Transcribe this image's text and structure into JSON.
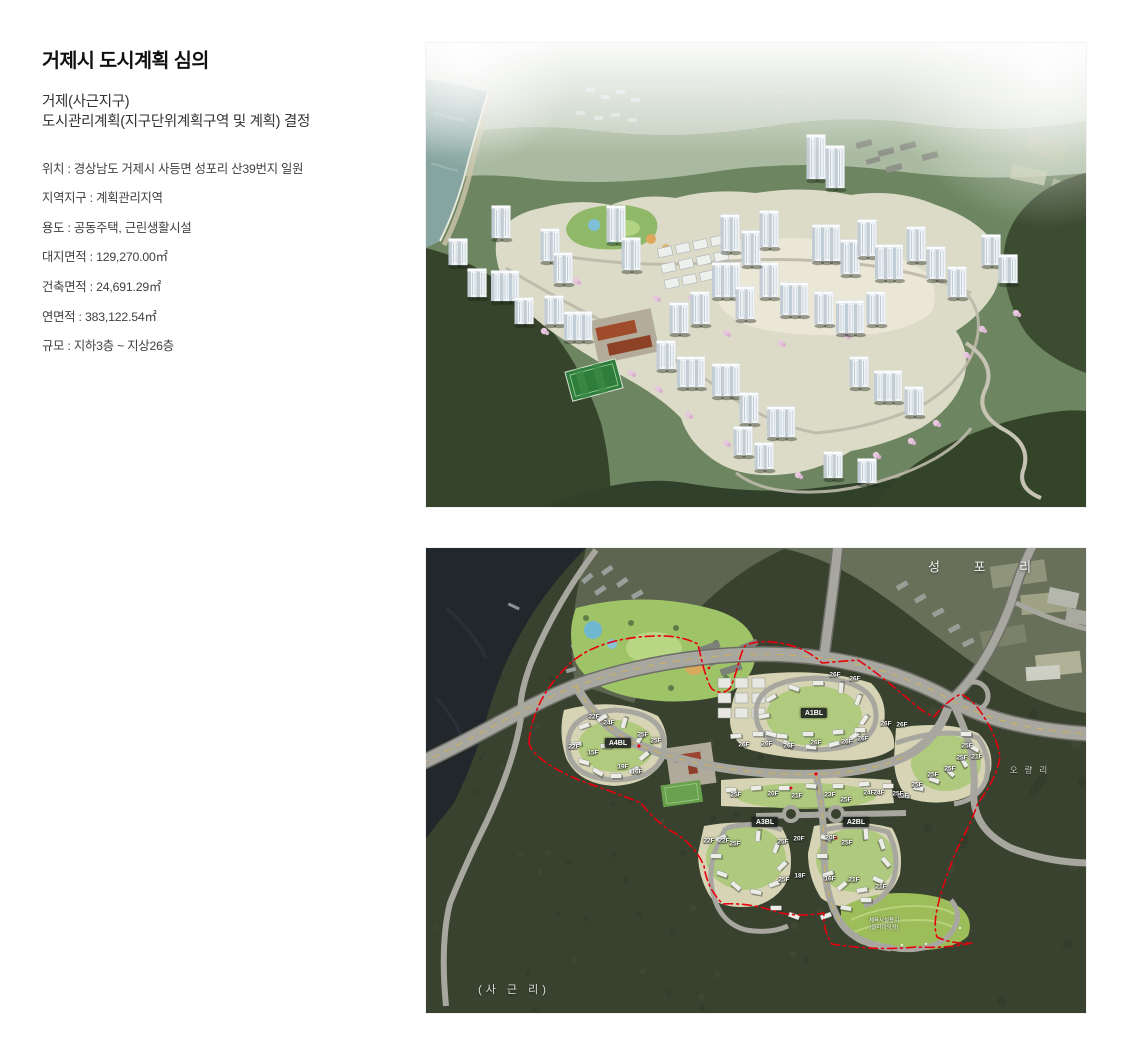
{
  "info": {
    "title": "거제시 도시계획 심의",
    "subtitle_line1": "거제(사근지구)",
    "subtitle_line2": "도시관리계획(지구단위계획구역 및 계획) 결정",
    "details": [
      "위치 : 경상남도 거제시 사등면 성포리 산39번지 일원",
      "지역지구 : 계획관리지역",
      "용도 : 공동주택, 근린생활시설",
      "대지면적 : 129,270.00㎡",
      "건축면적 : 24,691.29㎡",
      "연면적 : 383,122.54㎡",
      "규모 : 지하3층 ~ 지상26층"
    ]
  },
  "site_plan": {
    "place_labels": [
      {
        "text": "성 포 리",
        "x": 561,
        "y": 18,
        "kind": "seongpo"
      },
      {
        "text": "(사 근 리)",
        "x": 88,
        "y": 441,
        "kind": "sageun"
      },
      {
        "text": "오량리",
        "x": 606,
        "y": 222,
        "kind": "oryang"
      }
    ],
    "block_labels": [
      {
        "text": "A1BL",
        "x": 388,
        "y": 165
      },
      {
        "text": "A4BL",
        "x": 192,
        "y": 195
      },
      {
        "text": "A3BL",
        "x": 339,
        "y": 274
      },
      {
        "text": "A2BL",
        "x": 430,
        "y": 274
      }
    ],
    "floor_labels": [
      {
        "t": "26F",
        "x": 409,
        "y": 127
      },
      {
        "t": "26F",
        "x": 429,
        "y": 131
      },
      {
        "t": "26F",
        "x": 460,
        "y": 176
      },
      {
        "t": "26F",
        "x": 476,
        "y": 177
      },
      {
        "t": "26F",
        "x": 318,
        "y": 197
      },
      {
        "t": "26F",
        "x": 341,
        "y": 196
      },
      {
        "t": "26F",
        "x": 363,
        "y": 198
      },
      {
        "t": "26F",
        "x": 390,
        "y": 195
      },
      {
        "t": "26F",
        "x": 421,
        "y": 194
      },
      {
        "t": "26F",
        "x": 437,
        "y": 191
      },
      {
        "t": "25F",
        "x": 541,
        "y": 198
      },
      {
        "t": "25F",
        "x": 536,
        "y": 210
      },
      {
        "t": "21F",
        "x": 551,
        "y": 209
      },
      {
        "t": "25F",
        "x": 524,
        "y": 221
      },
      {
        "t": "25F",
        "x": 507,
        "y": 227
      },
      {
        "t": "25F",
        "x": 491,
        "y": 237
      },
      {
        "t": "25F",
        "x": 477,
        "y": 248
      },
      {
        "t": "22F",
        "x": 168,
        "y": 169
      },
      {
        "t": "24F",
        "x": 183,
        "y": 175
      },
      {
        "t": "25F",
        "x": 217,
        "y": 187
      },
      {
        "t": "25F",
        "x": 230,
        "y": 193
      },
      {
        "t": "22F",
        "x": 148,
        "y": 199
      },
      {
        "t": "15F",
        "x": 167,
        "y": 205
      },
      {
        "t": "19F",
        "x": 197,
        "y": 219
      },
      {
        "t": "16F",
        "x": 211,
        "y": 224
      },
      {
        "t": "25F",
        "x": 310,
        "y": 247
      },
      {
        "t": "20F",
        "x": 347,
        "y": 246
      },
      {
        "t": "21F",
        "x": 371,
        "y": 248
      },
      {
        "t": "23F",
        "x": 404,
        "y": 247
      },
      {
        "t": "25F",
        "x": 420,
        "y": 252
      },
      {
        "t": "24F",
        "x": 443,
        "y": 245
      },
      {
        "t": "24F",
        "x": 453,
        "y": 245
      },
      {
        "t": "25F",
        "x": 472,
        "y": 246
      },
      {
        "t": "22F",
        "x": 283,
        "y": 293
      },
      {
        "t": "22F",
        "x": 298,
        "y": 293
      },
      {
        "t": "25F",
        "x": 309,
        "y": 296
      },
      {
        "t": "25F",
        "x": 357,
        "y": 294
      },
      {
        "t": "20F",
        "x": 373,
        "y": 291
      },
      {
        "t": "20F",
        "x": 405,
        "y": 290
      },
      {
        "t": "25F",
        "x": 421,
        "y": 295
      },
      {
        "t": "25F",
        "x": 358,
        "y": 332
      },
      {
        "t": "18F",
        "x": 374,
        "y": 328
      },
      {
        "t": "16F",
        "x": 404,
        "y": 331
      },
      {
        "t": "21F",
        "x": 428,
        "y": 332
      },
      {
        "t": "21F",
        "x": 455,
        "y": 339
      }
    ],
    "facility_label": {
      "line1": "체육시설용지",
      "line2": "(클라이밍장)",
      "x": 458,
      "y": 377
    }
  },
  "colors": {
    "boundary_red": "#e8000e",
    "forest_dark": "#343e2b",
    "road_gray": "#a7a7a0",
    "parcel_light": "#d7d4b6",
    "text_dark": "#111111",
    "text_body": "#404040"
  }
}
